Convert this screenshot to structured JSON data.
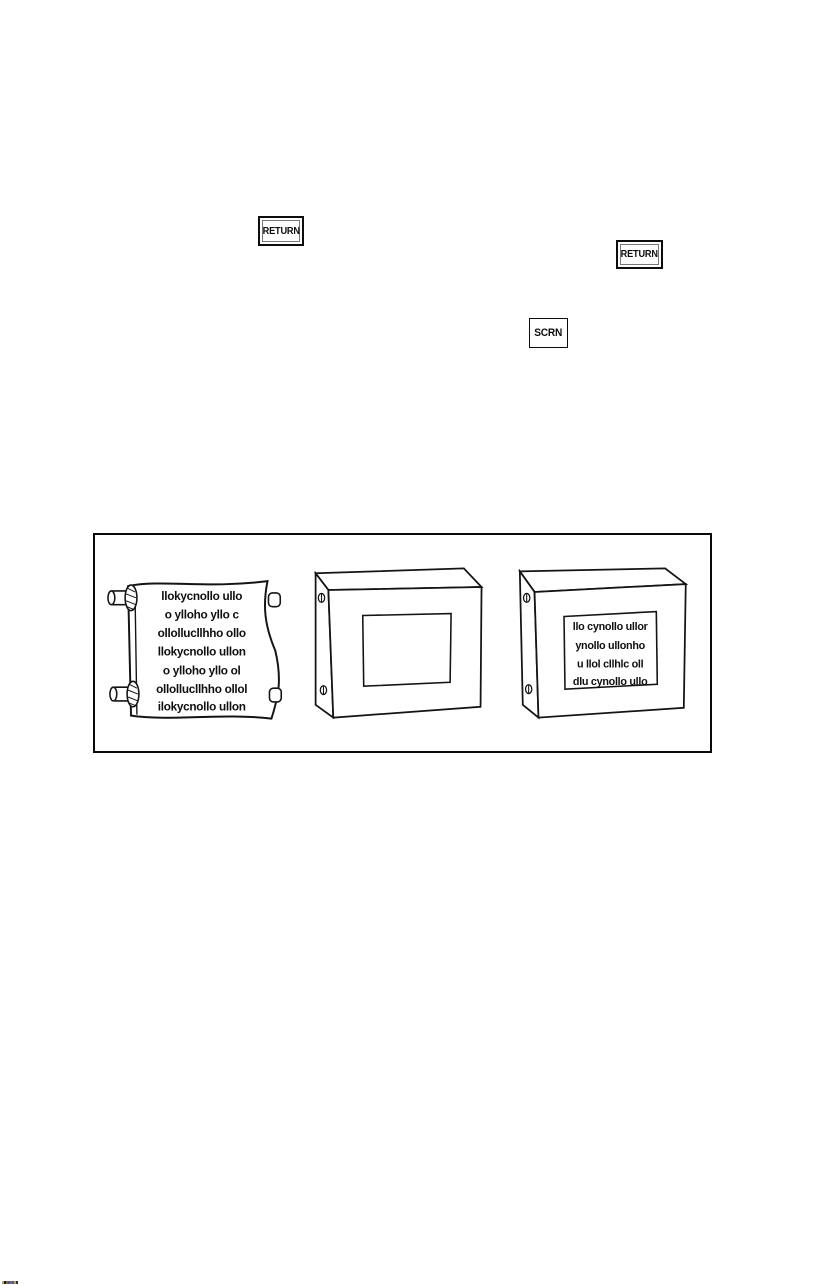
{
  "keys": {
    "return1": {
      "label": "RETURN"
    },
    "return2": {
      "label": "RETURN"
    },
    "scrn": {
      "label": "SCRN"
    }
  },
  "figure": {
    "scroll_lines": [
      "llokycnollo ullo",
      "o ylloho yllo c",
      "ollollucllhho ollo",
      "llokycnollo ullon",
      "o ylloho yllo ol",
      "ollollucllhho ollol",
      "ilokycnollo ullon"
    ],
    "panel_lines": [
      "llo cynollo ullor",
      "ynollo ullonho",
      "u llol cllhlc oll",
      "dlu cynollo ullo"
    ]
  },
  "artifacts": {
    "color_strip_colors": [
      "#d4b400",
      "#1a1a1a",
      "#c04848",
      "#5050b0",
      "#3a8888",
      "#8a3a8a",
      "#b0b050",
      "#303030"
    ]
  }
}
